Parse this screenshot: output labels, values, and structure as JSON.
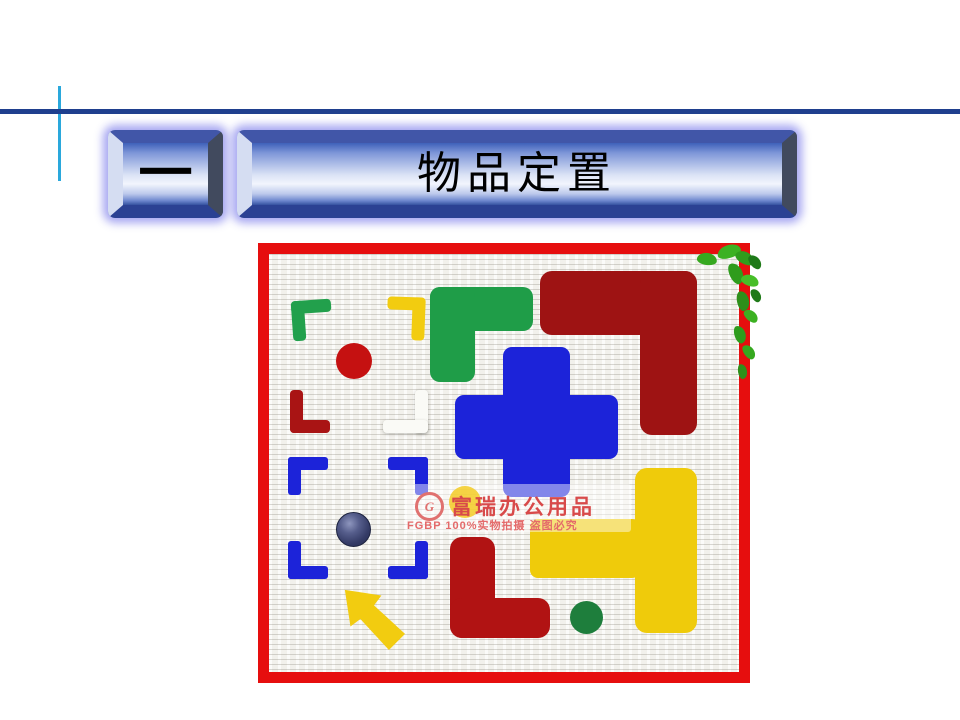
{
  "header": {
    "index_label": "一",
    "title": "物品定置"
  },
  "photo": {
    "watermark": {
      "logo_letter": "G",
      "brand": "富瑞办公用品",
      "tagline": "FGBP 100%实物拍摄 盗图必究"
    },
    "palette": {
      "frame_red": "#E60E0E",
      "marker_blue": "#1C23D9",
      "marker_green": "#1F9D48",
      "marker_yellow": "#F2CC10",
      "marker_maroon": "#9E1313",
      "marker_red_dot": "#C51111",
      "marker_green_dot": "#1E7E3C",
      "marker_white": "#FAFAF6",
      "coin_navy": "#343B66",
      "plant_green": "#36A81F"
    },
    "markers": [
      {
        "name": "green corner marker",
        "color": "#22A04C"
      },
      {
        "name": "yellow corner marker",
        "color": "#F2CC10"
      },
      {
        "name": "green L marker",
        "color": "#1F9D48"
      },
      {
        "name": "maroon L marker",
        "color": "#9E1313"
      },
      {
        "name": "blue cross marker",
        "color": "#1C23D9"
      },
      {
        "name": "white corner marker",
        "color": "#FAFAF6"
      },
      {
        "name": "red dot marker",
        "color": "#C51111"
      },
      {
        "name": "maroon corner marker",
        "color": "#A91414"
      },
      {
        "name": "blue corner brackets",
        "color": "#1C23D9"
      },
      {
        "name": "coin",
        "color": "#343B66"
      },
      {
        "name": "yellow arrow marker",
        "color": "#F2CC10"
      },
      {
        "name": "maroon bottom L marker",
        "color": "#B11313"
      },
      {
        "name": "yellow T marker",
        "color": "#EFCB0B"
      },
      {
        "name": "green dot marker",
        "color": "#1E7E3C"
      },
      {
        "name": "plant decoration",
        "color": "#36A81F"
      }
    ]
  },
  "decor": {
    "divider_navy": "#1F3F8E",
    "divider_cyan": "#2AA8DC",
    "banner_face_blue": "#3F61BA",
    "banner_glow": "#9696EE"
  }
}
